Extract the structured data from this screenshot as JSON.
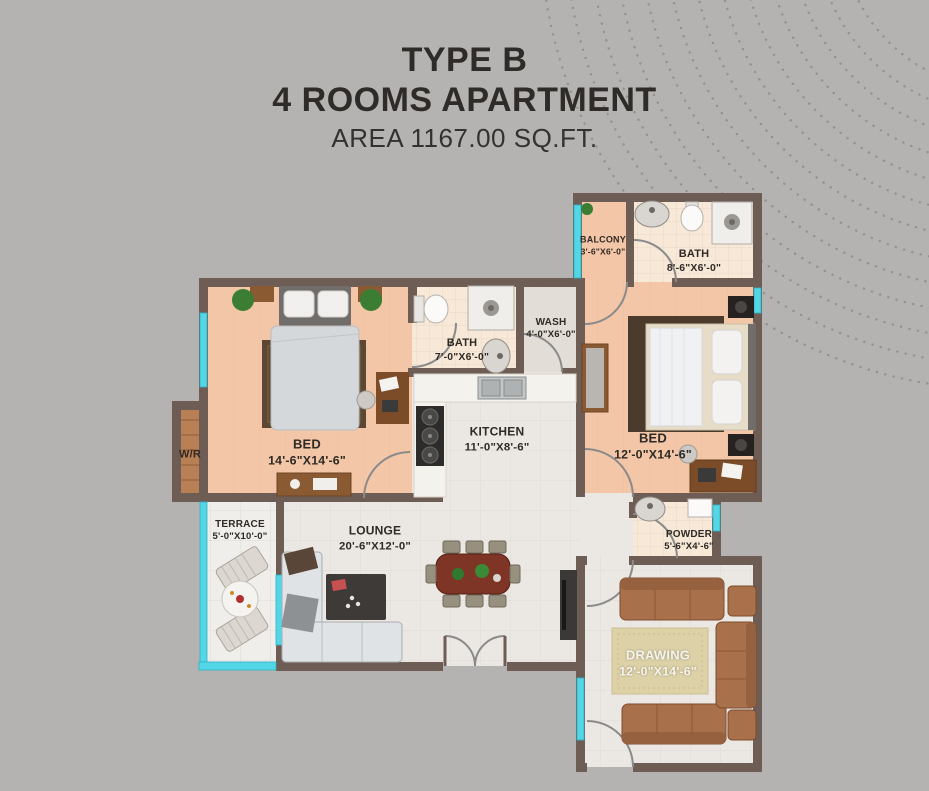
{
  "title": {
    "type_label": "TYPE B",
    "apartment_label": "4 ROOMS APARTMENT",
    "area_label": "AREA 1167.00 SQ.FT."
  },
  "rooms": [
    {
      "id": "balcony",
      "name": "BALCONY",
      "dims": "3'-6\"X6'-0\""
    },
    {
      "id": "bath-top",
      "name": "BATH",
      "dims": "8'-6\"X6'-0\""
    },
    {
      "id": "bath-mid",
      "name": "BATH",
      "dims": "7'-0\"X6'-0\""
    },
    {
      "id": "wash",
      "name": "WASH",
      "dims": "4'-0\"X6'-0\""
    },
    {
      "id": "kitchen",
      "name": "KITCHEN",
      "dims": "11'-0\"X8'-6\""
    },
    {
      "id": "bed-left",
      "name": "BED",
      "dims": "14'-6\"X14'-6\""
    },
    {
      "id": "bed-right",
      "name": "BED",
      "dims": "12'-0\"X14'-6\""
    },
    {
      "id": "wardrobe",
      "name": "W/R",
      "dims": ""
    },
    {
      "id": "terrace",
      "name": "TERRACE",
      "dims": "5'-0\"X10'-0\""
    },
    {
      "id": "lounge",
      "name": "LOUNGE",
      "dims": "20'-6\"X12'-0\""
    },
    {
      "id": "powder",
      "name": "POWDER",
      "dims": "5'-6\"X4'-6\""
    },
    {
      "id": "drawing",
      "name": "DRAWING",
      "dims": "12'-0\"X14'-6\""
    }
  ],
  "colors": {
    "background": "#b5b3b1",
    "wall": "#6e5d54",
    "window_glass": "#53d6e6",
    "floor_bedroom": "#f2c6a7",
    "floor_bath": "#f7e8d8",
    "floor_tile": "#ebe8e4",
    "wardrobe_wood": "#b97f55",
    "sofa_brown": "#a9714b",
    "label_text": "#2f2a25"
  }
}
